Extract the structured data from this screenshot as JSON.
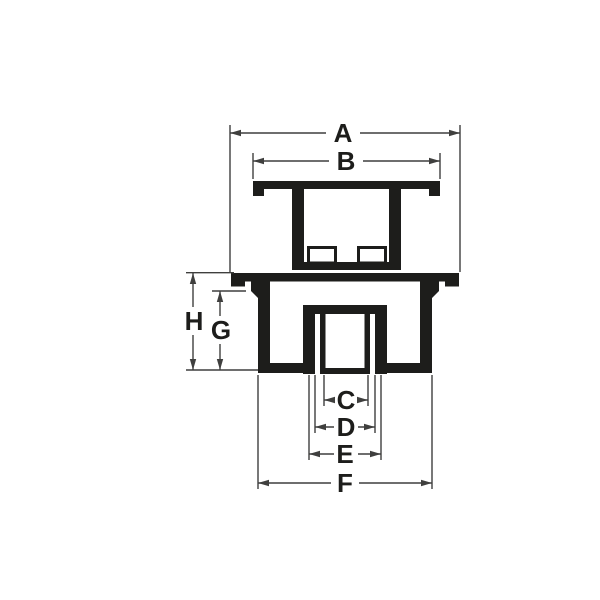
{
  "diagram": {
    "type": "technical-drawing",
    "view": "cross-section of a drain fitting: strainer cover above, threaded drain body below",
    "colors": {
      "ink": "#1d1d1b",
      "dimension_line": "#3f3f3e",
      "background": "#ffffff"
    },
    "dimensions": {
      "a": {
        "label": "A",
        "orientation": "horizontal",
        "measures": "overall body flange width"
      },
      "b": {
        "label": "B",
        "orientation": "horizontal",
        "measures": "strainer cover plate width"
      },
      "c": {
        "label": "C",
        "orientation": "horizontal",
        "measures": "bore inner width"
      },
      "d": {
        "label": "D",
        "orientation": "horizontal",
        "measures": "inner pipe outer width"
      },
      "e": {
        "label": "E",
        "orientation": "horizontal",
        "measures": "hub outer width"
      },
      "f": {
        "label": "F",
        "orientation": "horizontal",
        "measures": "body bottom outer width"
      },
      "g": {
        "label": "G",
        "orientation": "vertical",
        "measures": "wall height below flange"
      },
      "h": {
        "label": "H",
        "orientation": "vertical",
        "measures": "overall body height"
      }
    }
  }
}
